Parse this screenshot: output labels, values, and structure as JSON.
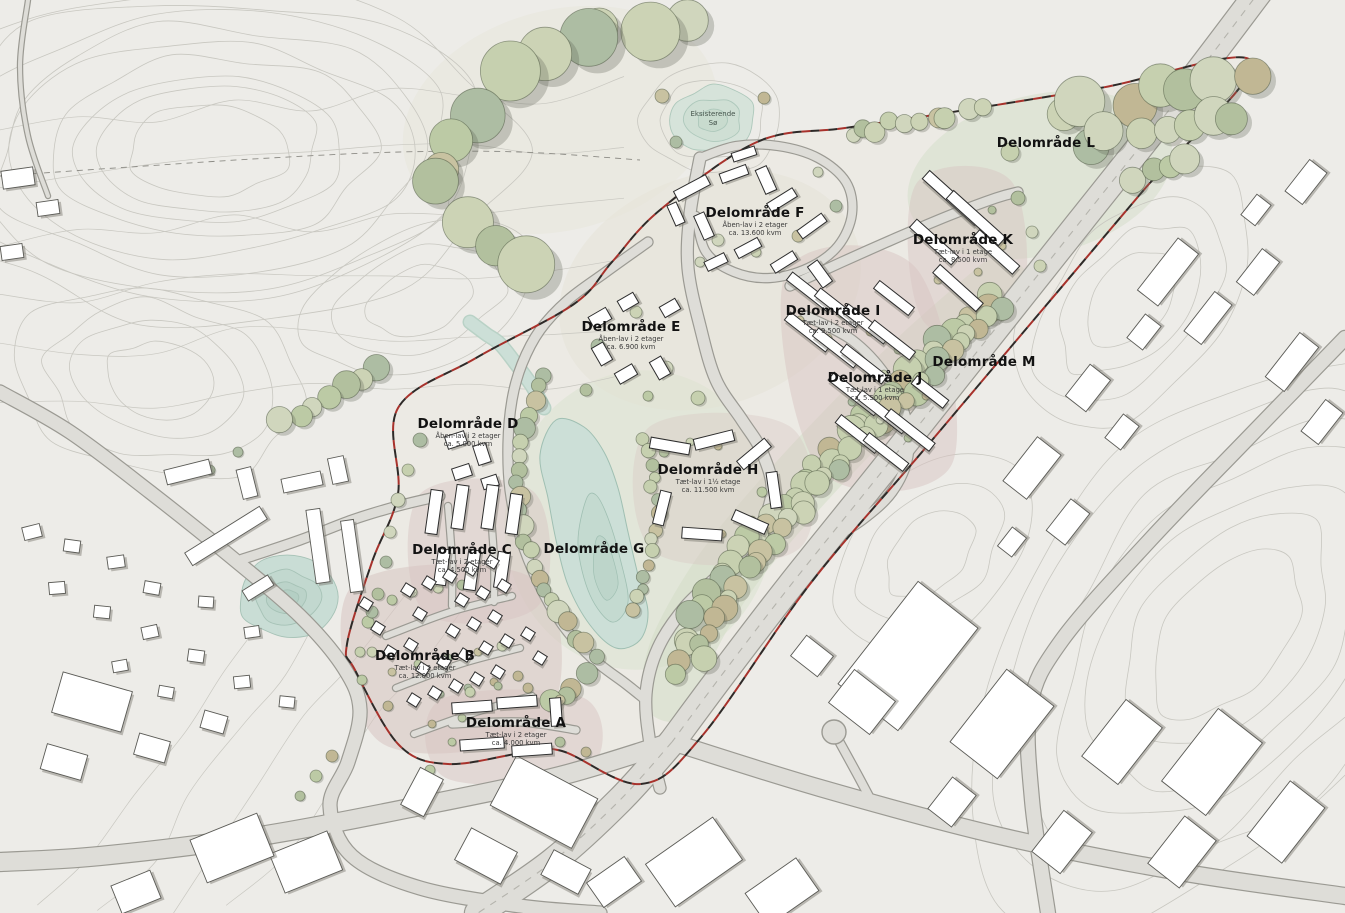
{
  "page": {
    "type": "site-development-plan",
    "language": "da"
  },
  "areas": [
    {
      "id": "A",
      "label": "Delområde A",
      "sub1": "Tæt-lav i 2 etager",
      "sub2": "ca. 4.000 kvm",
      "x": 516,
      "y": 727
    },
    {
      "id": "B",
      "label": "Delområde B",
      "sub1": "Tæt-lav i 2 etager",
      "sub2": "ca. 12.000 kvm",
      "x": 425,
      "y": 660
    },
    {
      "id": "C",
      "label": "Delområde C",
      "sub1": "Tæt-lav i 2 etager",
      "sub2": "ca. 4.500 kvm",
      "x": 462,
      "y": 554
    },
    {
      "id": "D",
      "label": "Delområde D",
      "sub1": "Åben-lav i 2 etager",
      "sub2": "ca. 5.000 kvm",
      "x": 468,
      "y": 428
    },
    {
      "id": "E",
      "label": "Delområde E",
      "sub1": "Åben-lav i 2 etager",
      "sub2": "ca. 6.900 kvm",
      "x": 631,
      "y": 331
    },
    {
      "id": "F",
      "label": "Delområde F",
      "sub1": "Åben-lav i 2 etager",
      "sub2": "ca. 13.600 kvm",
      "x": 755,
      "y": 217
    },
    {
      "id": "G",
      "label": "Delområde G",
      "sub1": "",
      "sub2": "",
      "x": 594,
      "y": 553
    },
    {
      "id": "H",
      "label": "Delområde H",
      "sub1": "Tæt-lav i 1½ etage",
      "sub2": "ca. 11.500 kvm",
      "x": 708,
      "y": 474
    },
    {
      "id": "I",
      "label": "Delområde I",
      "sub1": "Tæt-lav i 2 etager",
      "sub2": "ca. 9.500 kvm",
      "x": 833,
      "y": 315
    },
    {
      "id": "J",
      "label": "Delområde J",
      "sub1": "Tæt-lav i 1 etage",
      "sub2": "ca. 5.500 kvm",
      "x": 875,
      "y": 382
    },
    {
      "id": "K",
      "label": "Delområde K",
      "sub1": "Tæt-lav i 1 etage",
      "sub2": "ca. 8.500 kvm",
      "x": 963,
      "y": 244
    },
    {
      "id": "L",
      "label": "Delområde L",
      "sub1": "",
      "sub2": "",
      "x": 1046,
      "y": 147
    },
    {
      "id": "M",
      "label": "Delområde M",
      "sub1": "",
      "sub2": "",
      "x": 984,
      "y": 366
    }
  ],
  "water_label": {
    "line1": "Eksisterende",
    "line2": "Sø",
    "x": 713,
    "y": 116
  },
  "colors": {
    "background": "#edece8",
    "contour": "#c8c7c0",
    "road_fill": "#deddd8",
    "road_casing": "#9b9a93",
    "water": "#ccdfd7",
    "water_edge": "#9fbfb2",
    "building_fill": "#ffffff",
    "building_stroke": "#2d2d2d",
    "tree_greens": [
      "#c6d0af",
      "#bccaa5",
      "#ccd3b5",
      "#b2c09e",
      "#c8c2a1",
      "#c1b794",
      "#adbda3",
      "#d0d6bd"
    ],
    "development_ground": "#d7c4c1",
    "boundary_red": "#a8322c",
    "boundary_black": "#2e2a28",
    "label_text": "#121212"
  }
}
